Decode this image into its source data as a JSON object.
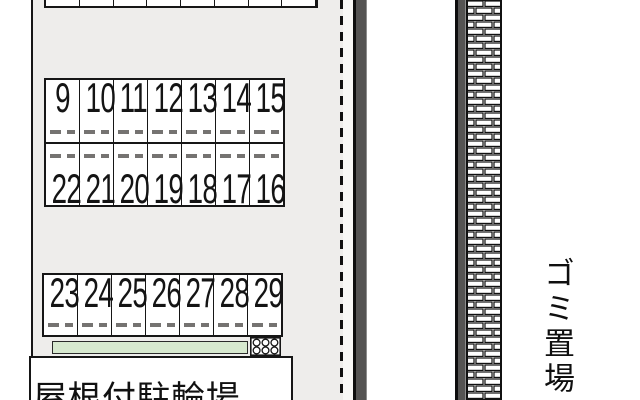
{
  "diagram": {
    "type": "parking-site-plan",
    "labels": {
      "covered_bicycle_parking": "屋根付駐輪場",
      "garbage_area": "ゴミ置場"
    },
    "blocks": {
      "top_partial": {
        "spots_visible": 8
      },
      "middle_top_row": [
        "9",
        "10",
        "11",
        "12",
        "13",
        "14",
        "15"
      ],
      "middle_bottom_row": [
        "22",
        "21",
        "20",
        "19",
        "18",
        "17",
        "16"
      ],
      "bottom_row": [
        "23",
        "24",
        "25",
        "26",
        "27",
        "28",
        "29"
      ]
    },
    "colors": {
      "site_fill": "#eeedeb",
      "green_strip": "#d7e9cf",
      "wall_fill": "#555453",
      "line": "#161616"
    }
  }
}
